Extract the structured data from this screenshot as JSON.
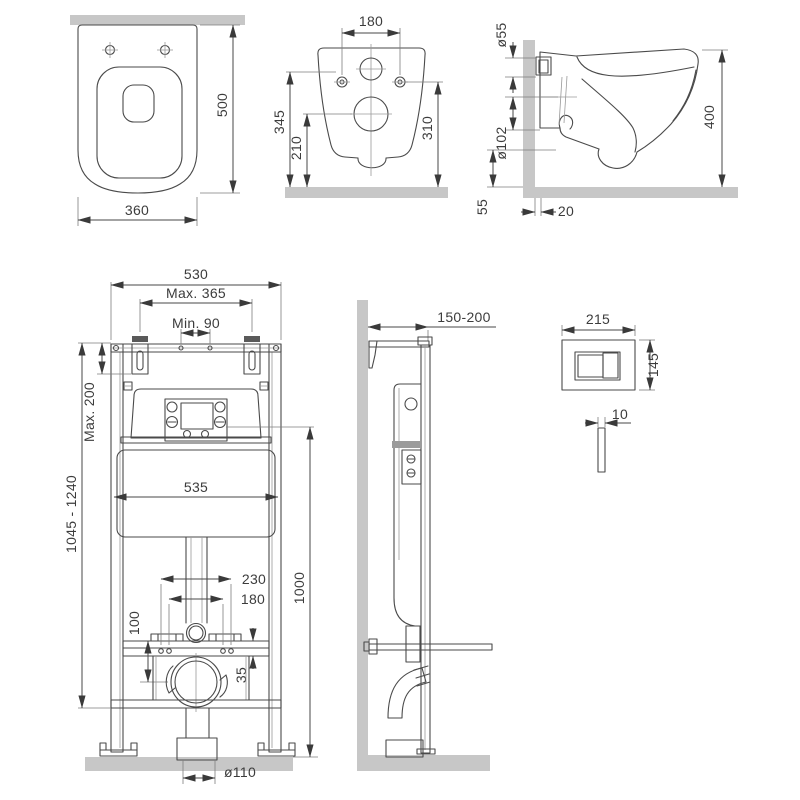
{
  "drawing": {
    "type": "installation-diagram",
    "subject": "wall-hung toilet with concealed cistern frame and flush plate",
    "views": {
      "toilet_top": {
        "depth": "500",
        "width": "360"
      },
      "toilet_back": {
        "hole_spacing": "180",
        "h_inlet": "345",
        "h_drain": "210",
        "h_holes": "310"
      },
      "toilet_side": {
        "d_inlet": "ø55",
        "d_outlet": "ø102",
        "height": "400",
        "clearance": "55",
        "wall_gap": "20"
      },
      "frame_front": {
        "width": "530",
        "max_top": "Max. 365",
        "min_top": "Min. 90",
        "max_depth": "Max. 200",
        "height_range": "1045 - 1240",
        "tank_width": "535",
        "outer_studs": "230",
        "inner_studs": "180",
        "drain_height": "100",
        "rail_gap": "35",
        "button_height": "1000",
        "drain_diameter": "ø110"
      },
      "frame_side": {
        "depth_range": "150-200"
      },
      "flush_plate": {
        "width": "215",
        "height": "145",
        "thickness": "10"
      }
    },
    "colors": {
      "line": "#4a4a4a",
      "wall_floor": "#c7c7c7",
      "background": "#ffffff"
    }
  }
}
